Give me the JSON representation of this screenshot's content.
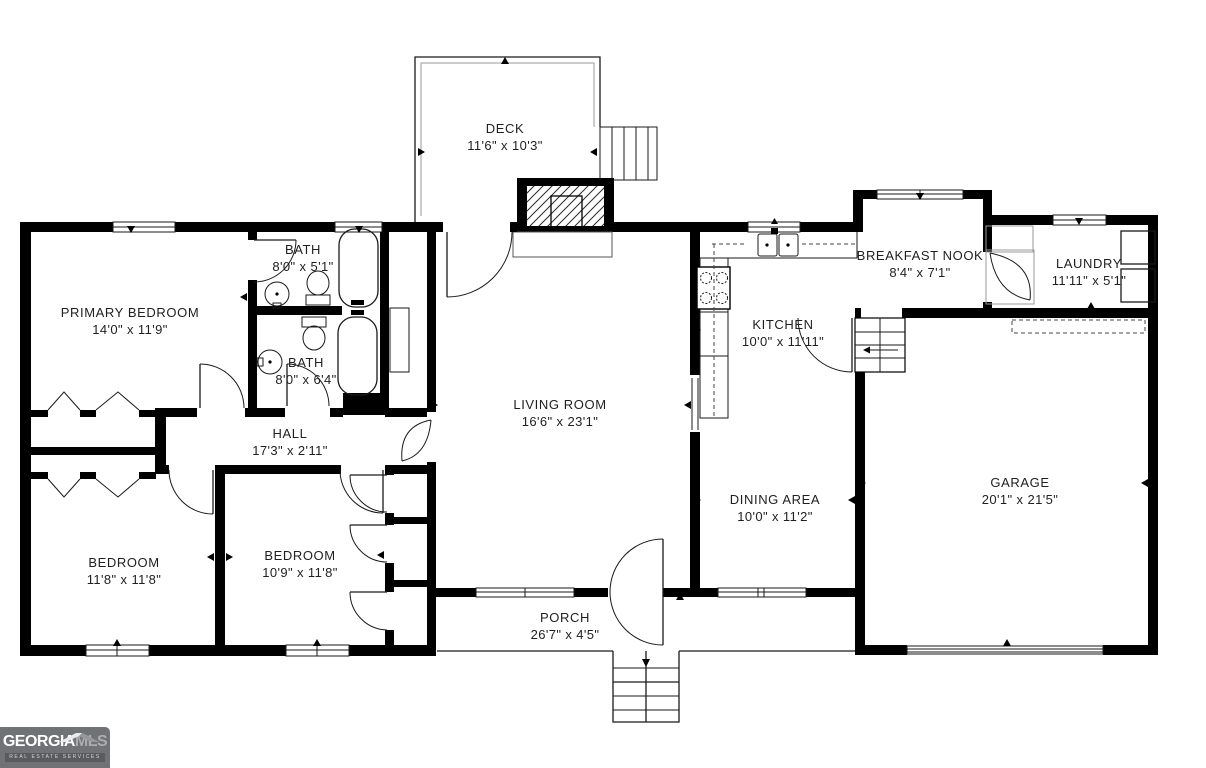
{
  "page": {
    "background": "#ffffff",
    "wall_color": "#000000",
    "text_color": "#1f1f1f"
  },
  "rooms": [
    {
      "name": "DECK",
      "dims": "11'6\" x 10'3\""
    },
    {
      "name": "PRIMARY BEDROOM",
      "dims": "14'0\" x 11'9\""
    },
    {
      "name": "BATH",
      "dims": "8'0\" x 5'1\""
    },
    {
      "name": "BATH",
      "dims": "8'0\" x 6'4\""
    },
    {
      "name": "HALL",
      "dims": "17'3\" x 2'11\""
    },
    {
      "name": "BEDROOM",
      "dims": "11'8\" x 11'8\""
    },
    {
      "name": "BEDROOM",
      "dims": "10'9\" x 11'8\""
    },
    {
      "name": "LIVING ROOM",
      "dims": "16'6\" x 23'1\""
    },
    {
      "name": "KITCHEN",
      "dims": "10'0\" x 11'11\""
    },
    {
      "name": "BREAKFAST NOOK",
      "dims": "8'4\" x 7'1\""
    },
    {
      "name": "LAUNDRY",
      "dims": "11'11\" x 5'1\""
    },
    {
      "name": "DINING AREA",
      "dims": "10'0\" x 11'2\""
    },
    {
      "name": "GARAGE",
      "dims": "20'1\" x 21'5\""
    },
    {
      "name": "PORCH",
      "dims": "26'7\" x 4'5\""
    }
  ],
  "logo": {
    "brand_primary": "GEORGIA",
    "brand_secondary": "MLS",
    "tagline": "REAL ESTATE SERVICES",
    "bg_color": "#717275",
    "accent_color": "#aaacaf"
  }
}
